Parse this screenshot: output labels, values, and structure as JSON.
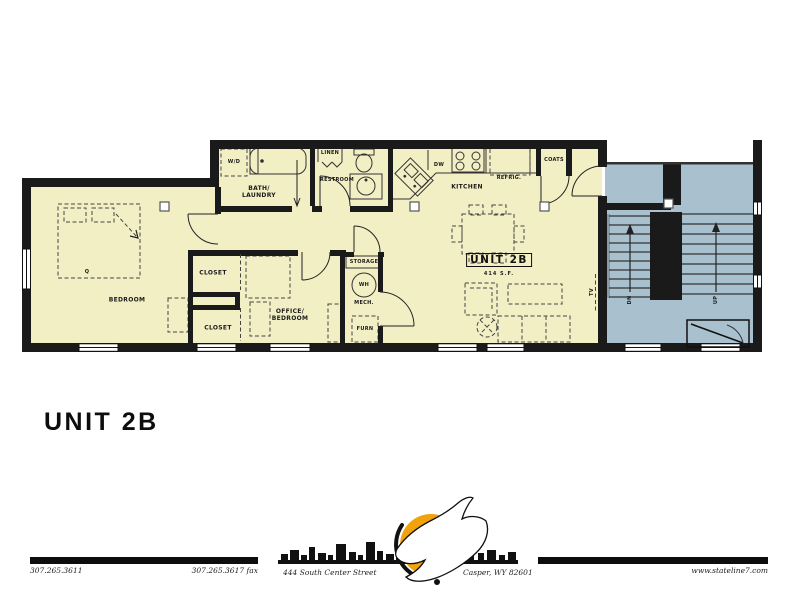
{
  "title": "UNIT 2B",
  "plan": {
    "unit_box": {
      "label": "UNIT 2B",
      "area": "414 S.F."
    },
    "labels": {
      "bedroom": "BEDROOM",
      "closet1": "CLOSET",
      "closet2": "CLOSET",
      "office": "OFFICE/\nBEDROOM",
      "bath": "BATH/\nLAUNDRY",
      "wd": "W/D",
      "linen": "LINEN",
      "restroom": "RESTROOM",
      "kitchen": "KITCHEN",
      "dw": "DW",
      "refrig": "REFRIG.",
      "coats": "COATS",
      "storage": "STORAGE",
      "wh": "WH",
      "mech": "MECH.",
      "furn": "FURN",
      "q": "Q",
      "tv": "TV",
      "dn": "DN",
      "up": "UP"
    }
  },
  "footer": {
    "phone": "307.265.3611",
    "fax": "307.265.3617 fax",
    "address": "444 South Center Street",
    "city": "Casper, WY 82601",
    "website": "www.stateline7.com"
  },
  "colors": {
    "unit_fill": "#f3efc5",
    "stair_fill": "#a9c1cf",
    "wall": "#1a1a1a",
    "sun": "#F2A30C"
  }
}
